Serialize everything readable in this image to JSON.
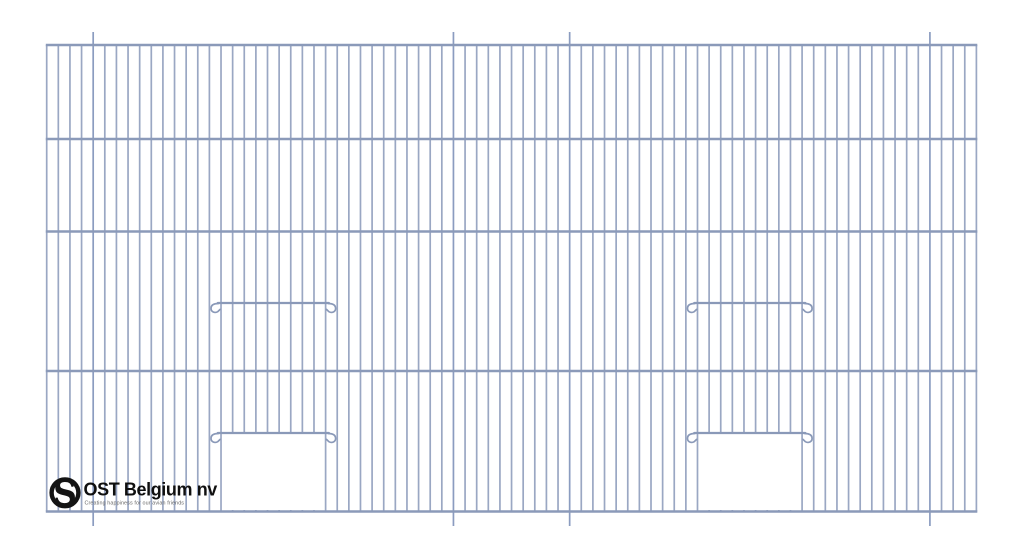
{
  "drawing": {
    "kind": "bird-cage-front-wire-panel",
    "canvas": {
      "width": 1024,
      "height": 559
    },
    "colors": {
      "background": "#ffffff",
      "vertical_wire": "#9aa7c3",
      "extended_wire": "#8b9cc0",
      "horizontal_wire": "#8b9ab9",
      "latch_wire": "#8a99b8"
    },
    "frame": {
      "left": 46.7,
      "right": 976.4,
      "top": 45,
      "bottom": 511.5
    },
    "vertical_wires": {
      "count": 81,
      "width": 1.7,
      "extended_indices": [
        4,
        35,
        45,
        76
      ],
      "top_extension": 13,
      "bottom_extension": 14.5
    },
    "horizontal_wires": {
      "ys": [
        45,
        139,
        231.5,
        371,
        511.5
      ],
      "width": 2.6
    },
    "doors": [
      {
        "id": "left-door",
        "left_wire_index": 15,
        "right_wire_index": 24,
        "upper_bar_y": 303,
        "lower_bar_y": 433,
        "bar_half_span": 55.5,
        "opening_top": 434,
        "opening_bottom": 510
      },
      {
        "id": "right-door",
        "left_wire_index": 56,
        "right_wire_index": 65,
        "upper_bar_y": 303,
        "lower_bar_y": 433,
        "bar_half_span": 55.5,
        "opening_top": 434,
        "opening_bottom": 510
      }
    ],
    "logo": {
      "brand": "OST Belgium nv",
      "tagline": "Creating happiness for our avian friends",
      "monogram": "S",
      "colors": {
        "text": "#0f0f0f",
        "tagline": "#6a6a6a",
        "ring": "#141414",
        "ring_fill": "#ffffff"
      }
    }
  }
}
